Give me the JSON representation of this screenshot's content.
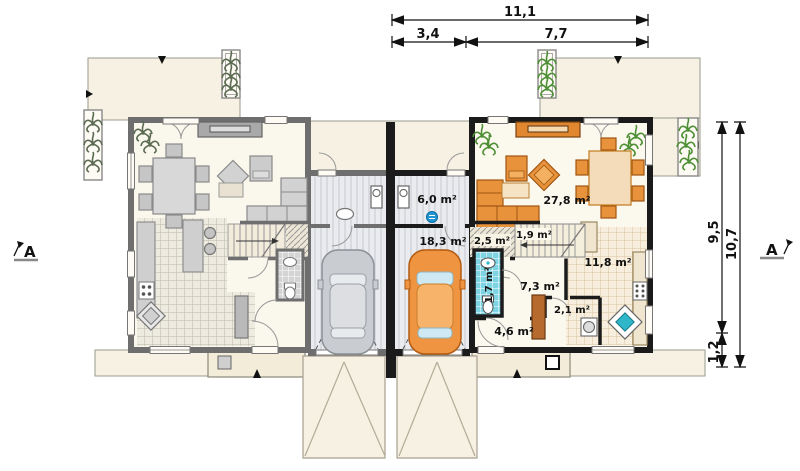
{
  "plan": {
    "dimensions": {
      "top_total": "11,1",
      "top_seg_left": "3,4",
      "top_seg_right": "7,7",
      "right_upper": "9,5",
      "right_lower": "1,2",
      "right_total": "10,7"
    },
    "section_marker": "A",
    "rooms": {
      "storage": "6,0 m²",
      "garage": "18,3 m²",
      "corridor": "2,5 m²",
      "understairs": "1,9 m²",
      "wc": "1,7 m²",
      "hall": "7,3 m²",
      "vestibule": "4,6 m²",
      "pantry": "2,1 m²",
      "kitchen": "11,8 m²",
      "living": "27,8 m²"
    },
    "colors": {
      "accent_orange": "#e8923c",
      "wall_black": "#1b1b1b",
      "wall_gray": "#6e6e6e",
      "floor_cream": "#faf7ec",
      "terrace_cream": "#f6f1e2",
      "tile_blue": "#7fd4e4",
      "sink_teal": "#2fb6c9",
      "plant_green": "#4e8f35",
      "plant_gray_green": "#5c6b52",
      "furniture_gray": "#d2d2d2"
    }
  }
}
